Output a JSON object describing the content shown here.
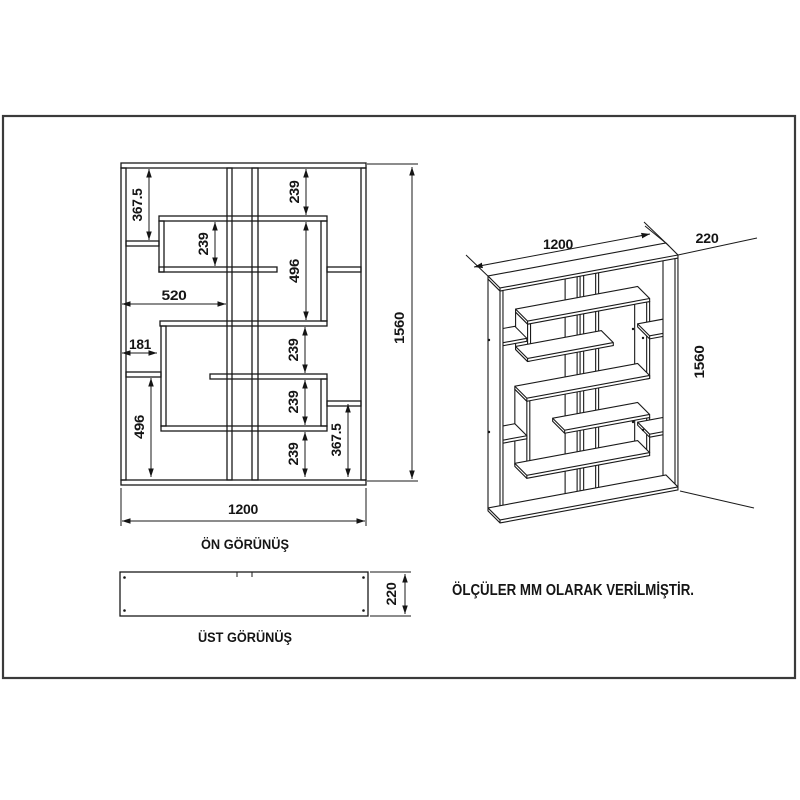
{
  "drawing": {
    "note": "ÖLÇÜLER MM OLARAK VERİLMİŞTİR.",
    "front_view": {
      "title": "ÖN GÖRÜNÜŞ",
      "dims": {
        "left_top": "367.5",
        "top_right": "239",
        "upper_inner": "239",
        "upper_box": "496",
        "shelf_520": "520",
        "shelf_181": "181",
        "mid_a": "239",
        "mid_b": "239",
        "mid_c": "239",
        "lower_left": "496",
        "lower_right": "367.5",
        "height": "1560",
        "width": "1200"
      }
    },
    "top_view": {
      "title": "ÜST GÖRÜNÜŞ",
      "depth": "220"
    },
    "iso_view": {
      "width": "1200",
      "depth": "220",
      "height": "1560"
    }
  }
}
